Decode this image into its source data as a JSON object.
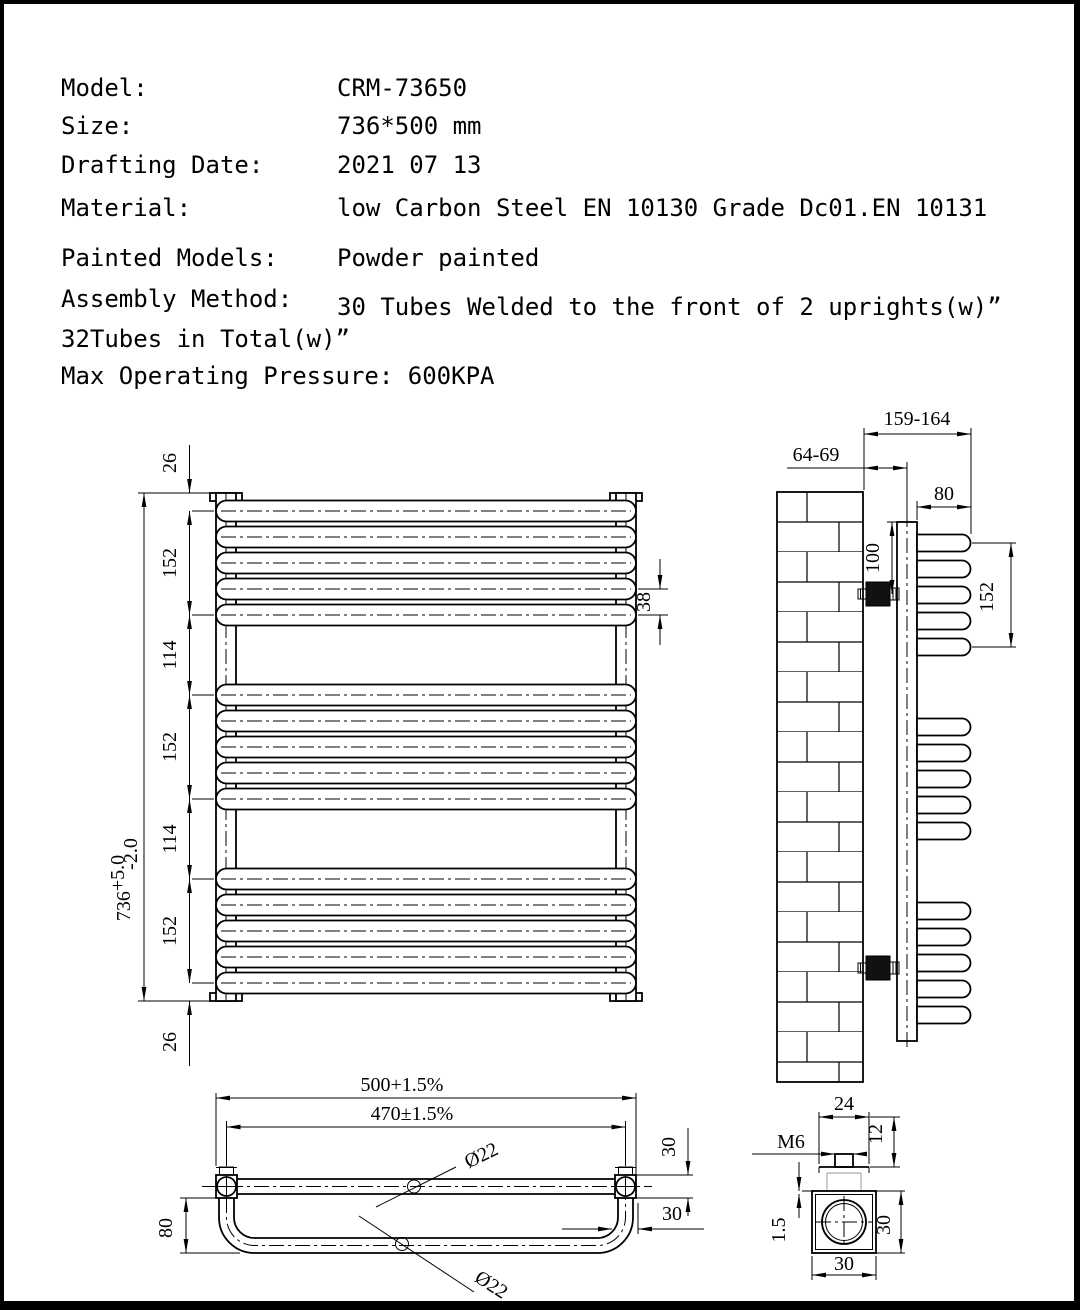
{
  "specs": {
    "rows": [
      {
        "label": "Model:",
        "value": "CRM-73650"
      },
      {
        "label": "Size:",
        "value": "736*500 mm"
      },
      {
        "label": "Drafting Date:",
        "value": "2021 07 13"
      },
      {
        "label": "Material:",
        "value": "low Carbon Steel  EN 10130 Grade Dc01.EN 10131"
      },
      {
        "label": "Painted Models:",
        "value": "Powder painted"
      },
      {
        "label": "Assembly Method:",
        "value": "30 Tubes Welded to the front of 2 uprights(w)”"
      }
    ],
    "total_note": "32Tubes in Total(w)”",
    "pressure_note": "Max Operating Pressure: 600KPA"
  },
  "front_view": {
    "overall_height": "736",
    "tol_plus": "+5.0",
    "tol_minus": "-2.0",
    "top_offset": "26",
    "group_span_1": "152",
    "gap_1": "114",
    "group_span_2": "152",
    "gap_2": "114",
    "group_span_3": "152",
    "bottom_offset": "26",
    "tube_pitch": "38"
  },
  "side_view": {
    "wall_to_tube_front": "159-164",
    "wall_to_upright_axis": "64-69",
    "tube_depth": "80",
    "top_to_bracket": "100",
    "group_span": "152"
  },
  "plan_view": {
    "overall_width": "500+1.5%",
    "upright_centres": "470±1.5%",
    "tube_diameter": "Ø22",
    "loop_tube_diameter": "Ø22",
    "loop_depth": "80",
    "upright_depth": "30",
    "loop_offset": "30"
  },
  "detail_view": {
    "boss_width": "24",
    "boss_height": "12",
    "thread_size": "M6",
    "wall_thickness": "1.5",
    "section_width": "30",
    "section_height": "30"
  }
}
